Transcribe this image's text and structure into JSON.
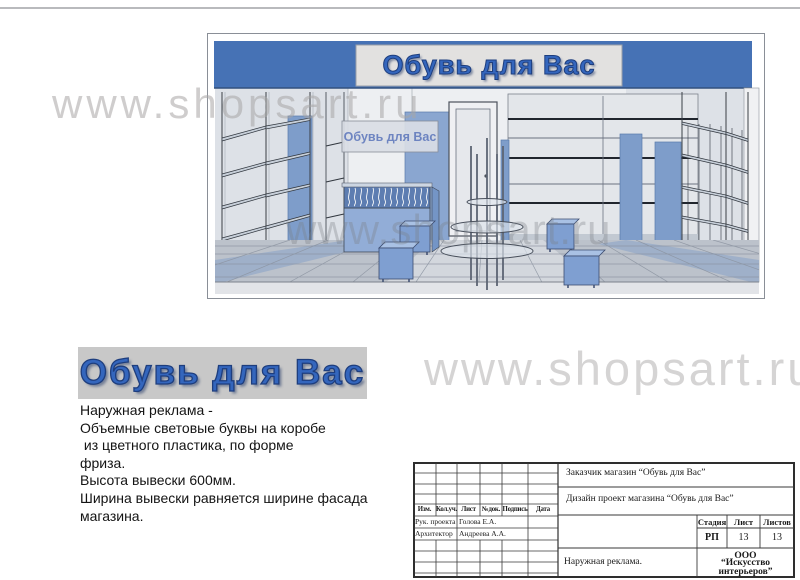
{
  "watermarks": {
    "top": "www.shopsart.ru",
    "render": "www.shopsart.ru",
    "middle": "www.shopsart.ru"
  },
  "storefront": {
    "sign": "Обувь для Вас",
    "interior_sign": "Обувь для Вас"
  },
  "logo": {
    "text": "Обувь для Вас"
  },
  "description": {
    "lines": [
      "Наружная реклама -",
      "Объемные световые буквы на коробе",
      " из цветного пластика, по форме",
      "фриза.",
      "Высота вывески 600мм.",
      "Ширина вывески равняется ширине фасада",
      "магазина."
    ]
  },
  "stamp": {
    "customer": "Заказчик магазин “Обувь для Вас”",
    "project": "Дизайн проект магазина “Обувь для Вас”",
    "cols": [
      "Изм.",
      "Кол.уч.",
      "Лист",
      "№док.",
      "Подпись",
      "Дата"
    ],
    "roles": [
      {
        "role": "Рук. проекта",
        "name": "Голова Е.А."
      },
      {
        "role": "Архитектор",
        "name": "Андреева А.А."
      }
    ],
    "stage_label": "Стадия",
    "sheet_label": "Лист",
    "sheets_label": "Листов",
    "stage": "РП",
    "sheet": "13",
    "sheets": "13",
    "subject": "Наружная  реклама.",
    "company_line1": "ООО",
    "company_line2": "“Искусство интерьеров”"
  },
  "colors": {
    "fascia_blue": "#4672b5",
    "logo_blue": "#3466bd",
    "panel_blue": "#7e9dca",
    "logo_background": "#c8c8c8"
  }
}
